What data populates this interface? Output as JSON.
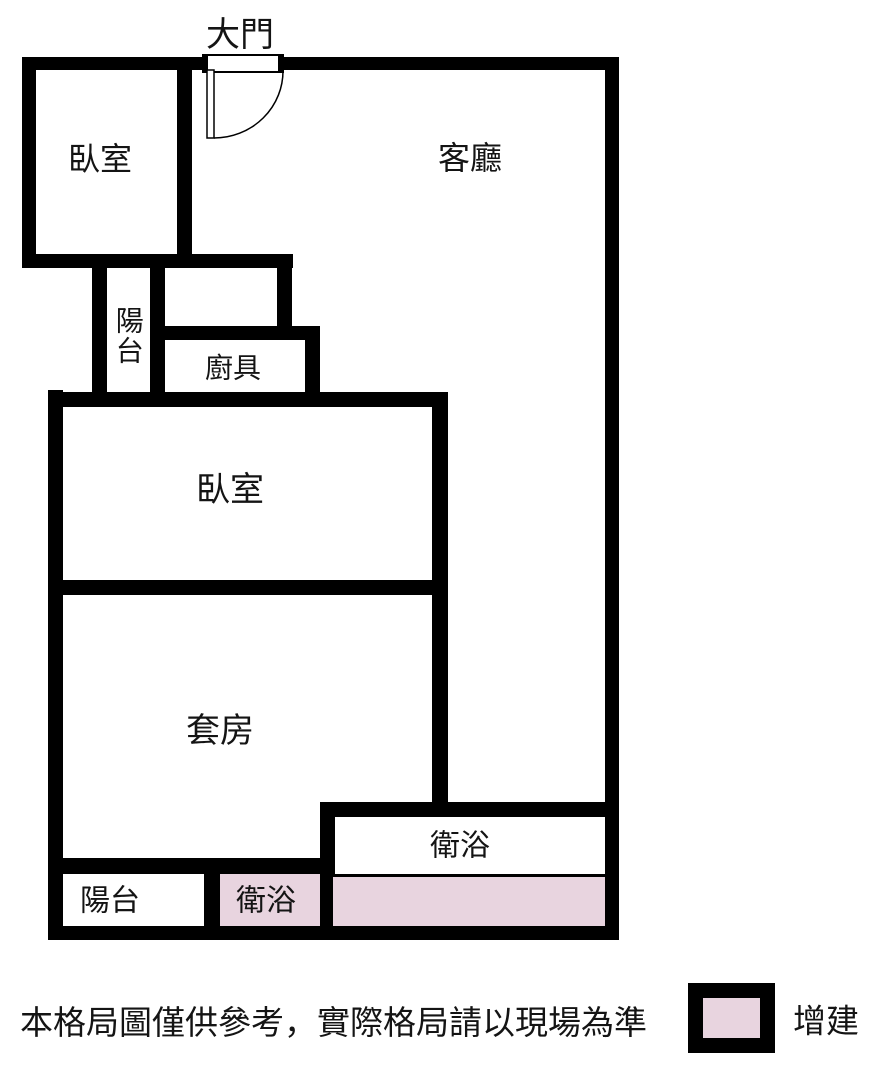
{
  "title": "apartment-floor-plan",
  "rooms": {
    "main_door": {
      "label": "大門"
    },
    "bedroom_top": {
      "label": "臥室"
    },
    "living_room": {
      "label": "客廳"
    },
    "balcony_mid": {
      "label": "陽台",
      "orientation": "vertical"
    },
    "kitchen": {
      "label": "廚具"
    },
    "bedroom_mid": {
      "label": "臥室"
    },
    "suite": {
      "label": "套房"
    },
    "bathroom_main": {
      "label": "衛浴"
    },
    "balcony_bottom": {
      "label": "陽台"
    },
    "bathroom_addition": {
      "label": "衛浴",
      "highlight": "addition"
    }
  },
  "colors": {
    "wall": "#000000",
    "addition_fill": "#e8d4df",
    "background": "#ffffff",
    "text": "#141414"
  },
  "footer": {
    "disclaimer": "本格局圖僅供參考，實際格局請以現場為準",
    "legend": {
      "label": "增建",
      "swatch_color": "#e8d4df"
    }
  }
}
